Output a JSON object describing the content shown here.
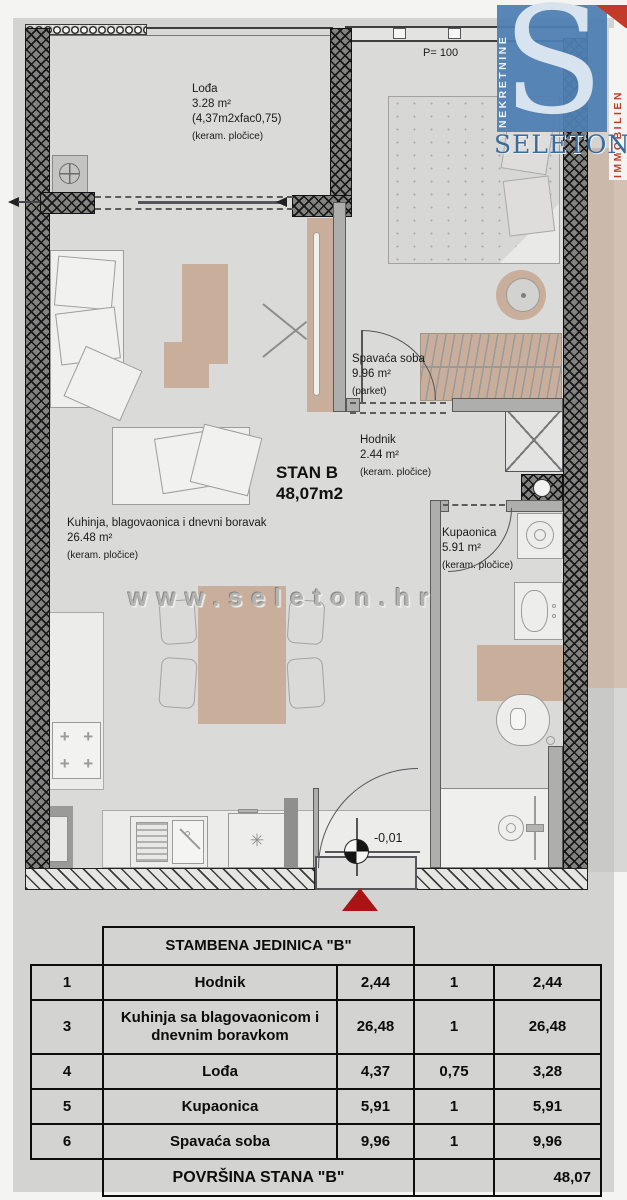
{
  "logo": {
    "letter": "S",
    "vertical_left": "NEKRETNINE",
    "vertical_right": "IMMOBILIEN",
    "wordmark": "SELETON",
    "blue": "#4e80b2",
    "red": "#c23b28"
  },
  "plan": {
    "watermark": "www.seleton.hr",
    "parapet": "P= 100",
    "level": "-0,01",
    "unit_title": "STAN B",
    "unit_area": "48,07m2",
    "loggia": {
      "name": "Lođa",
      "area": "3.28 m²",
      "calc": "(4,37m2xfac0,75)",
      "finish": "(keram. pločice)"
    },
    "bedroom": {
      "name": "Spavaća soba",
      "area": "9.96 m²",
      "finish": "(parket)"
    },
    "hall": {
      "name": "Hodnik",
      "area": "2.44 m²",
      "finish": "(keram. pločice)"
    },
    "kitchen": {
      "name": "Kuhinja, blagovaonica i dnevni boravak",
      "area": "26.48 m²",
      "finish": "(keram. pločice)"
    },
    "bath": {
      "name": "Kupaonica",
      "area": "5.91 m²",
      "finish": "(keram. pločice)"
    }
  },
  "icons": {
    "burner": "+",
    "dishwasher": "✳"
  },
  "table": {
    "title": "STAMBENA JEDINICA \"B\"",
    "rows": [
      {
        "no": "1",
        "name": "Hodnik",
        "area": "2,44",
        "coef": "1",
        "total": "2,44"
      },
      {
        "no": "3",
        "name": "Kuhinja sa blagovaonicom i dnevnim boravkom",
        "area": "26,48",
        "coef": "1",
        "total": "26,48"
      },
      {
        "no": "4",
        "name": "Lođa",
        "area": "4,37",
        "coef": "0,75",
        "total": "3,28"
      },
      {
        "no": "5",
        "name": "Kupaonica",
        "area": "5,91",
        "coef": "1",
        "total": "5,91"
      },
      {
        "no": "6",
        "name": "Spavaća soba",
        "area": "9,96",
        "coef": "1",
        "total": "9,96"
      }
    ],
    "footer": {
      "label": "POVRŠINA STANA \"B\"",
      "total": "48,07"
    }
  },
  "colors": {
    "background": "#d3d3d1",
    "floor": "#dadad8",
    "wall": "#17171b",
    "furniture_tan": "#c9ae9b",
    "entrance_marker": "#aa1414"
  }
}
